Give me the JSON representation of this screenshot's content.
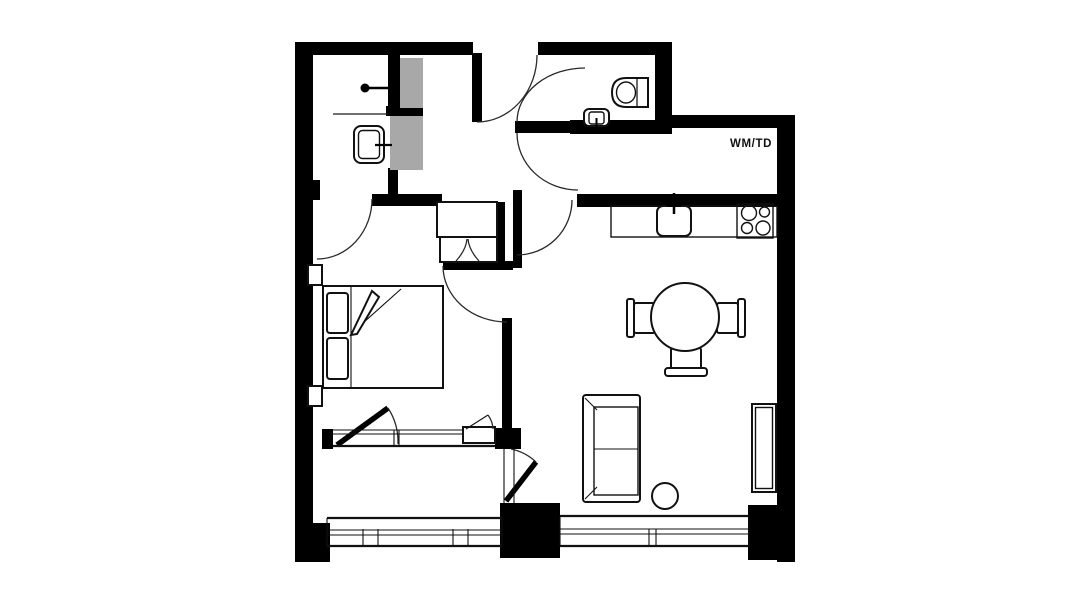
{
  "floorplan": {
    "title": "apartment-floor-plan",
    "wm_td_label": "WM/TD",
    "colors": {
      "wall": "#000000",
      "background": "#ffffff",
      "shaft_fill": "#a8a8a8",
      "line": "#1a1a1a"
    },
    "fixtures": [
      "shower-head",
      "ensuite-sink",
      "toilet",
      "wc-sink",
      "kitchen-counter",
      "kitchen-sink",
      "cooktop",
      "dining-table",
      "dining-chair-left",
      "dining-chair-right",
      "dining-chair-bottom",
      "sofa",
      "side-table",
      "tv-unit",
      "bed",
      "pillows",
      "wardrobe-closet",
      "balcony-railing",
      "window-band",
      "door-swing-arcs",
      "service-shafts"
    ]
  }
}
